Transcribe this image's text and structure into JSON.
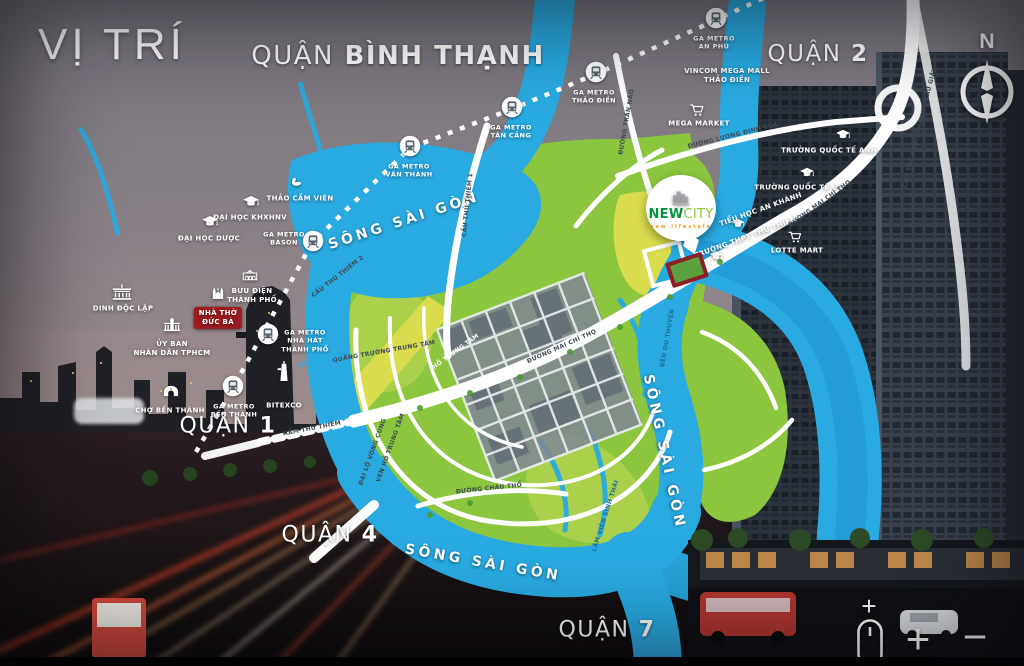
{
  "title": "VỊ TRÍ",
  "districts": [
    {
      "prefix": "QUẬN",
      "name": "BÌNH THẠNH",
      "x": 398,
      "y": 57,
      "size": 26
    },
    {
      "prefix": "QUẬN",
      "name": "2",
      "x": 818,
      "y": 55,
      "size": 23
    },
    {
      "prefix": "QUẬN",
      "name": "1",
      "x": 228,
      "y": 427,
      "size": 22
    },
    {
      "prefix": "QUẬN",
      "name": "4",
      "x": 330,
      "y": 536,
      "size": 22
    },
    {
      "prefix": "QUẬN",
      "name": "7",
      "x": 607,
      "y": 631,
      "size": 22
    }
  ],
  "rivers": [
    {
      "text": "SÔNG SÀI GÒN",
      "x": 404,
      "y": 221,
      "rot": -18
    },
    {
      "text": "SÔNG SÀI GÒN",
      "x": 664,
      "y": 452,
      "rot": 78
    },
    {
      "text": "SÔNG SÀI GÒN",
      "x": 483,
      "y": 563,
      "rot": 10
    }
  ],
  "metro_stations": [
    {
      "label": "GA METRO\nBẾN THÀNH",
      "ix": 233,
      "iy": 386,
      "lx": 234,
      "ly": 411
    },
    {
      "label": "GA METRO\nNHÀ HÁT\nTHÀNH PHỐ",
      "ix": 268,
      "iy": 334,
      "lx": 305,
      "ly": 341
    },
    {
      "label": "GA METRO\nBASON",
      "ix": 313,
      "iy": 241,
      "lx": 284,
      "ly": 239
    },
    {
      "label": "GA METRO\nVĂN THÀNH",
      "ix": 410,
      "iy": 146,
      "lx": 409,
      "ly": 171
    },
    {
      "label": "GA METRO\nTÂN CẢNG",
      "ix": 512,
      "iy": 107,
      "lx": 511,
      "ly": 132
    },
    {
      "label": "GA METRO\nTHẢO ĐIỀN",
      "ix": 596,
      "iy": 72,
      "lx": 594,
      "ly": 97
    },
    {
      "label": "GA METRO\nAN PHÚ",
      "ix": 716,
      "iy": 18,
      "lx": 714,
      "ly": 43
    }
  ],
  "landmarks": [
    {
      "icon": "bird",
      "s": 16,
      "ix": 297,
      "iy": 183,
      "label": "THẢO CẦM VIÊN",
      "lx": 300,
      "ly": 199
    },
    {
      "icon": "gradcap",
      "s": 17,
      "ix": 251,
      "iy": 202,
      "label": "ĐẠI HỌC KHXHNV",
      "lx": 250,
      "ly": 218
    },
    {
      "icon": "gradcap",
      "s": 17,
      "ix": 210,
      "iy": 222,
      "label": "ĐẠI HỌC DƯỢC",
      "lx": 209,
      "ly": 239
    },
    {
      "icon": "palace",
      "s": 22,
      "ix": 122,
      "iy": 293,
      "label": "DINH ĐỘC LẬP",
      "lx": 123,
      "ly": 309
    },
    {
      "icon": "post",
      "s": 19,
      "ix": 250,
      "iy": 275,
      "label": "BƯU ĐIỆN\nTHÀNH PHỐ",
      "lx": 252,
      "ly": 296
    },
    {
      "icon": "church",
      "s": 20,
      "ix": 218,
      "iy": 294,
      "label": "NHÀ THỜ\nĐỨC BÀ",
      "lx": 218,
      "ly": 318,
      "badge": true
    },
    {
      "icon": "gov",
      "s": 21,
      "ix": 172,
      "iy": 325,
      "label": "ỦY BAN\nNHÂN DÂN TPHCM",
      "lx": 172,
      "ly": 349
    },
    {
      "icon": "market",
      "s": 19,
      "ix": 171,
      "iy": 391,
      "label": "CHỢ BẾN THÀNH",
      "lx": 170,
      "ly": 411
    },
    {
      "icon": "tower",
      "s": 24,
      "ix": 284,
      "iy": 372,
      "label": "BITEXCO",
      "lx": 284,
      "ly": 406
    },
    {
      "label": "VINCOM MEGA MALL\nTHẢO ĐIỀN",
      "lx": 727,
      "ly": 76
    },
    {
      "icon": "cart",
      "s": 16,
      "ix": 697,
      "iy": 110,
      "label": "MEGA MARKET",
      "lx": 699,
      "ly": 124
    },
    {
      "icon": "gradcap",
      "s": 15,
      "ix": 843,
      "iy": 135,
      "label": "TRƯỜNG QUỐC TẾ ANH",
      "lx": 829,
      "ly": 151
    },
    {
      "icon": "gradcap",
      "s": 15,
      "ix": 807,
      "iy": 173,
      "label": "TRƯỜNG QUỐC TẾ ÚC",
      "lx": 799,
      "ly": 188
    },
    {
      "icon": "cart",
      "s": 15,
      "ix": 795,
      "iy": 237,
      "label": "LOTTE MART",
      "lx": 797,
      "ly": 251
    },
    {
      "icon": "gradcap",
      "s": 14,
      "ix": 738,
      "iy": 224,
      "label": "TIỂU HỌC AN KHÁNH",
      "lx": 761,
      "ly": 210,
      "rot": -20
    },
    {
      "icon": "gradcap",
      "s": 14,
      "ix": 716,
      "iy": 256,
      "label": "TRƯỜNG THPT THỦ THIÊM",
      "lx": 746,
      "ly": 238,
      "rot": -20
    }
  ],
  "road_labels": [
    {
      "text": "ĐƯỜNG TRẦN NÃO",
      "x": 627,
      "y": 122,
      "rot": -80
    },
    {
      "text": "ĐƯỜNG LƯƠNG ĐỊNH CỦA",
      "x": 733,
      "y": 136,
      "rot": -14
    },
    {
      "text": "CAO TỐC LONG THÀNH - DẦU GIÂY",
      "x": 920,
      "y": 128,
      "rot": -76
    },
    {
      "text": "ĐƯỜNG MAI CHÍ THỌ",
      "x": 820,
      "y": 204,
      "rot": -36
    },
    {
      "text": "ĐƯỜNG MAI CHÍ THỌ",
      "x": 562,
      "y": 347,
      "rot": -24
    },
    {
      "text": "ĐƯỜNG CHÂU THỔ",
      "x": 489,
      "y": 489,
      "rot": -6
    },
    {
      "text": "QUẢNG TRƯỜNG TRUNG TÂM",
      "x": 384,
      "y": 352,
      "rot": -10
    },
    {
      "text": "HẦM THỦ THIÊM",
      "x": 312,
      "y": 429,
      "rot": -11
    },
    {
      "text": "CẦU BA SON",
      "x": 319,
      "y": 361,
      "rot": -14,
      "color": "#29abe2"
    },
    {
      "text": "CẦU THỦ THIÊM 1",
      "x": 468,
      "y": 205,
      "rot": -84
    },
    {
      "text": "CẦU THỦ THIÊM 2",
      "x": 338,
      "y": 277,
      "rot": -38
    },
    {
      "text": "HỒ TRUNG TÂM",
      "x": 456,
      "y": 352,
      "rot": -36,
      "color": "#ffffff"
    },
    {
      "text": "BẾN DU THUYỀN",
      "x": 668,
      "y": 338,
      "rot": -80,
      "color": "#1c6f9e"
    },
    {
      "text": "LÂM VIÊN SINH THÁI",
      "x": 606,
      "y": 516,
      "rot": -72,
      "color": "#1c6f9e"
    },
    {
      "text": "ĐẠI LỘ VÒNG CUNG",
      "x": 373,
      "y": 452,
      "rot": -70
    },
    {
      "text": "VEN HỒ TRUNG TÂM",
      "x": 391,
      "y": 448,
      "rot": -70
    }
  ],
  "project": {
    "name_bold": "NEW",
    "name_light": "CITY",
    "tagline": "new lifestyle"
  },
  "compass": {
    "label": "N"
  },
  "controls": {
    "hint_plus": "+",
    "zoom_in": "+",
    "zoom_out": "−"
  },
  "colors": {
    "river": "#29abe2",
    "green": "#8cc63e",
    "green_light": "#abd14c",
    "yellow_green": "#d9dd4d",
    "road_label": "#3f4a55",
    "logo_green_dark": "#00953b",
    "logo_green": "#8dc63e",
    "tagline_orange": "#f7941d",
    "badge_red": "#9e1b1f"
  }
}
